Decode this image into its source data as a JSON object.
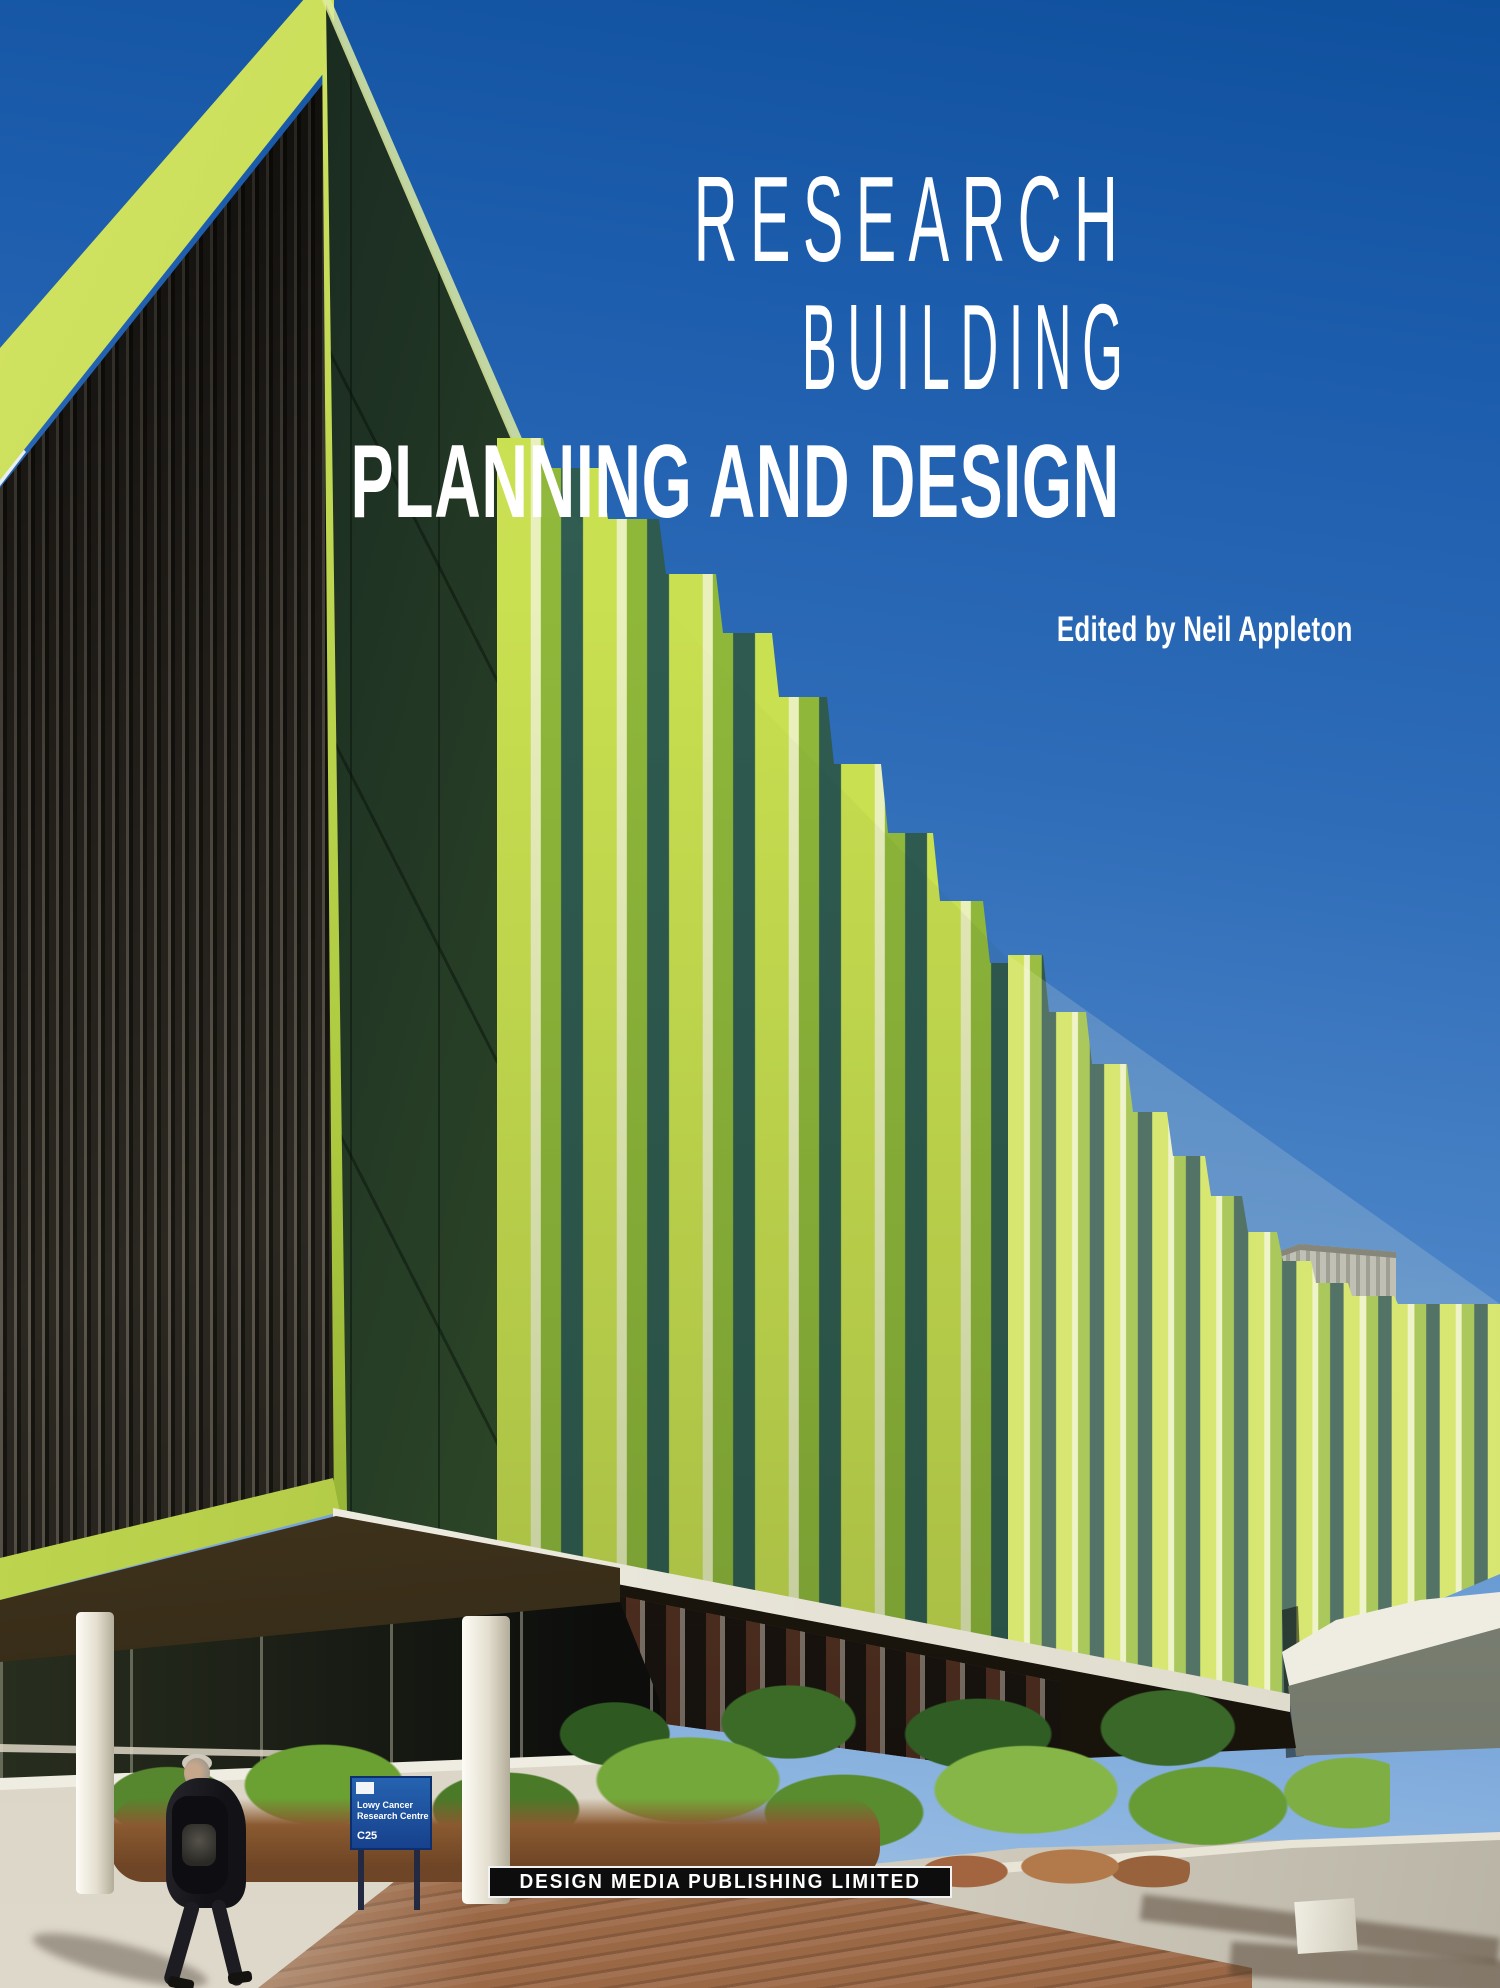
{
  "cover": {
    "title_line1": "RESEARCH",
    "title_line2": "BUILDING",
    "subtitle": "PLANNING AND DESIGN",
    "edited_by": "Edited by Neil Appleton",
    "publisher": "DESIGN MEDIA PUBLISHING LIMITED",
    "colors": {
      "sky_top": "#0f509d",
      "sky_bottom": "#b3cdea",
      "facade_lime": "#c9e050",
      "facade_dark_green": "#23392a",
      "glass_teal": "#2e5a50",
      "title_text": "#ffffff",
      "publisher_bar": "#0d0d0d",
      "sign_blue": "#1d55a8"
    }
  },
  "scene": {
    "building_sign": {
      "line1": "Lowy Cancer",
      "line2": "Research Centre",
      "code": "C25"
    }
  }
}
